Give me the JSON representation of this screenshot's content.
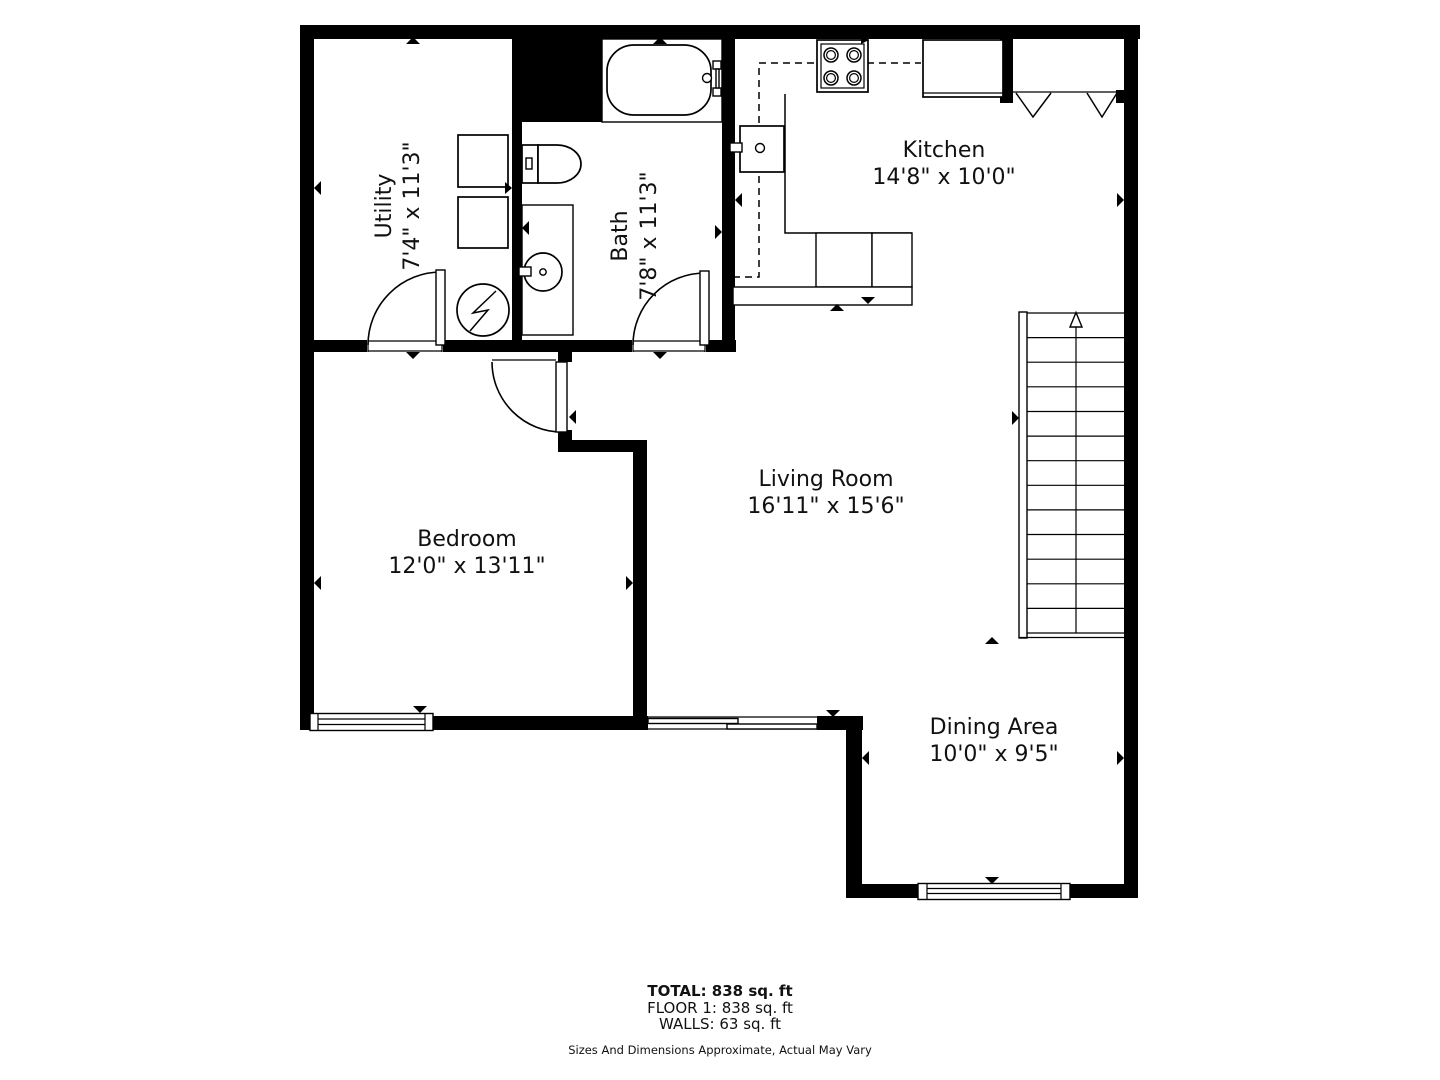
{
  "floor_plan": {
    "rooms": [
      {
        "name": "Utility",
        "dims": "7'4\" x 11'3\""
      },
      {
        "name": "Bath",
        "dims": "7'8\" x 11'3\""
      },
      {
        "name": "Kitchen",
        "dims": "14'8\" x 10'0\""
      },
      {
        "name": "Living Room",
        "dims": "16'11\" x 15'6\""
      },
      {
        "name": "Bedroom",
        "dims": "12'0\" x 13'11\""
      },
      {
        "name": "Dining Area",
        "dims": "10'0\" x 9'5\""
      }
    ],
    "summary": {
      "total": "TOTAL: 838 sq. ft",
      "floor": "FLOOR 1: 838 sq. ft",
      "walls": "WALLS: 63 sq. ft"
    },
    "disclaimer": "Sizes And Dimensions Approximate, Actual May Vary",
    "colors": {
      "wall": "#000000",
      "background": "#ffffff",
      "text": "#111111"
    }
  }
}
